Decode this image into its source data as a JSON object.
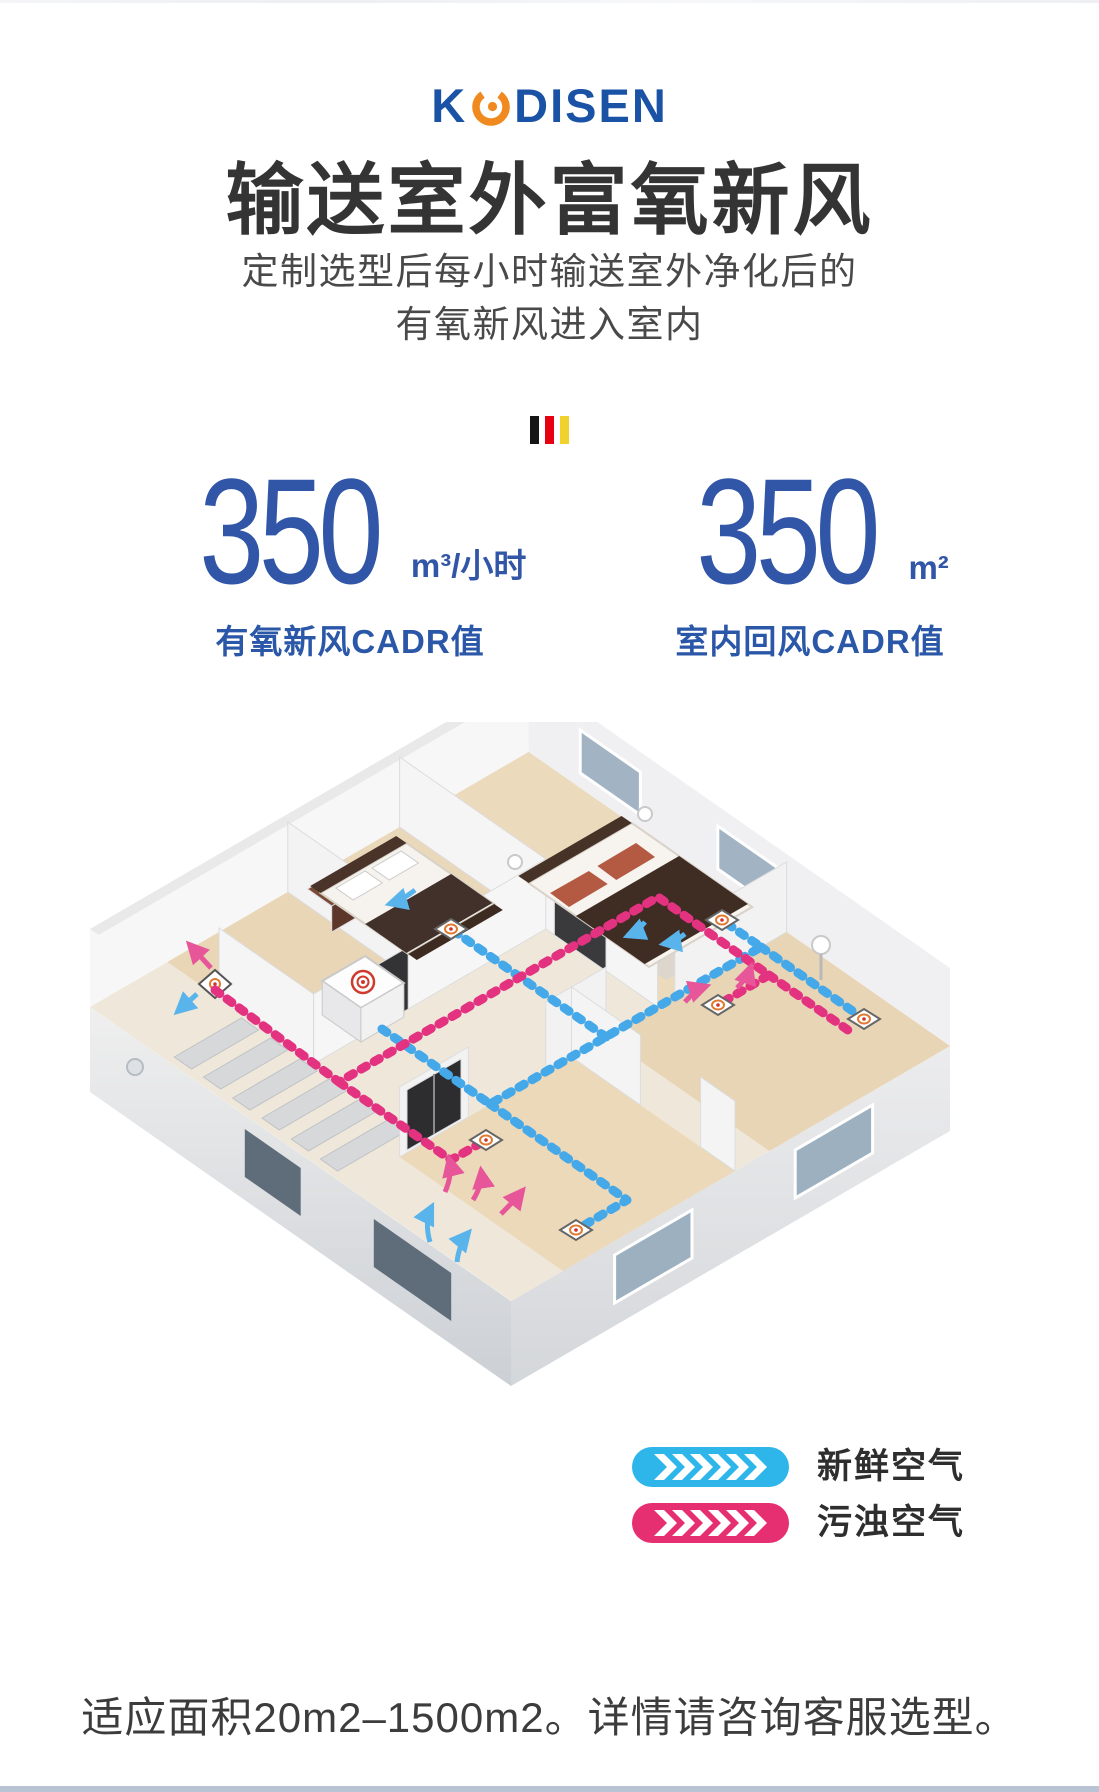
{
  "header": {
    "logo": {
      "text": "KODISEN",
      "left": "K",
      "right": "DISEN"
    },
    "title": "输送室外富氧新风",
    "subtitle_line1": "定制选型后每小时输送室外净化后的",
    "subtitle_line2": "有氧新风进入室内"
  },
  "divider_flag": {
    "colors": [
      "#161616",
      "#e60012",
      "#f1d12b"
    ]
  },
  "stats": [
    {
      "value": "350",
      "unit": "m³/小时",
      "label": "有氧新风CADR值"
    },
    {
      "value": "350",
      "unit": "m²",
      "label": "室内回风CADR值"
    }
  ],
  "diagram": {
    "type": "isometric-house-airflow",
    "legend": [
      {
        "label": "新鲜空气",
        "color": "#2eb6ea"
      },
      {
        "label": "污浊空气",
        "color": "#e62f70"
      }
    ],
    "duct_colors": {
      "fresh": "#45a8e8",
      "polluted": "#e23280"
    }
  },
  "icons": {
    "logo_o": "orange-swirl-ring",
    "divider": "german-flag-stripes",
    "legend_arrow": "white-chevron-run",
    "diffuser": "target-ring-diamond",
    "main_unit": "ventilation-unit-box"
  },
  "colors": {
    "brand_blue": "#1a53a6",
    "brand_orange": "#f08a1e",
    "stat_blue": "#2b57a8",
    "heading": "#343434",
    "floor_tan": "#ead8ba",
    "wall_gray": "#f3f3f4",
    "bottom_rule": "#b8c3d3"
  },
  "footer": {
    "note": "适应面积20m2–1500m2。详情请咨询客服选型。"
  }
}
